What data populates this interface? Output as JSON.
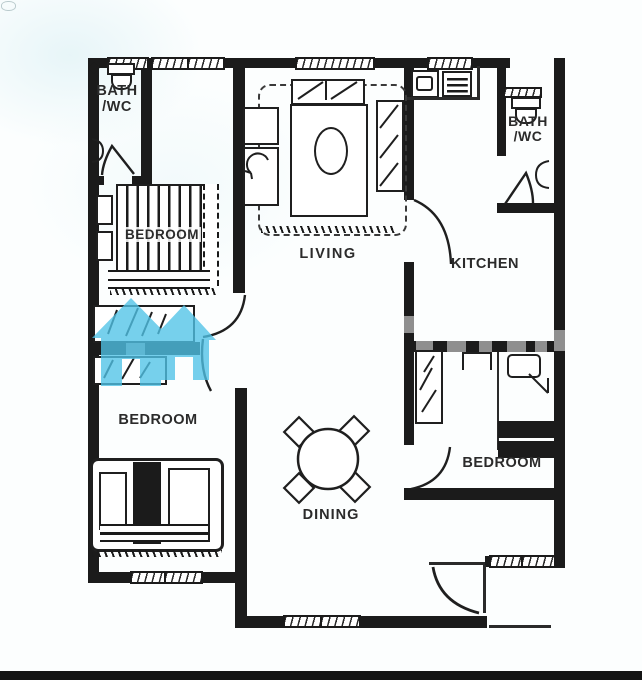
{
  "plan": {
    "rooms": {
      "bath_top_left": {
        "line1": "BATH",
        "line2": "/WC"
      },
      "bedroom_top_left": {
        "label": "BEDROOM"
      },
      "living": {
        "label": "LIVING"
      },
      "kitchen": {
        "label": "KITCHEN"
      },
      "bath_top_right": {
        "line1": "BATH",
        "line2": "/WC"
      },
      "bedroom_bottom_left": {
        "label": "BEDROOM"
      },
      "dining": {
        "label": "DINING"
      },
      "bedroom_bottom_right": {
        "label": "BEDROOM"
      }
    },
    "colors": {
      "wall": "#1b1b1b",
      "paper": "#fcfefe",
      "watermark_logo": "#50c3e7",
      "watermark_gray": "#8f8f8f"
    }
  }
}
